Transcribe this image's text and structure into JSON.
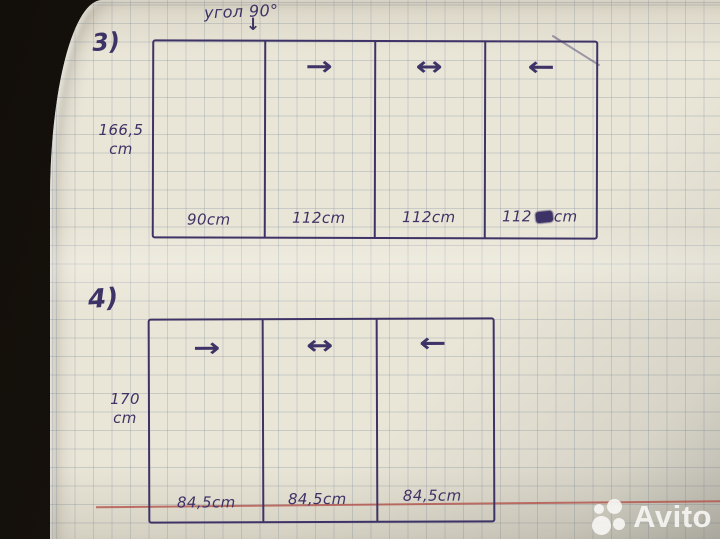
{
  "annotation": {
    "text": "угол 90°",
    "arrow": "↓"
  },
  "sketch3": {
    "label": "3)",
    "height_value": "166,5",
    "height_unit": "cm",
    "sections": [
      {
        "width_label": "90cm",
        "arrow": ""
      },
      {
        "width_label": "112cm",
        "arrow": "→"
      },
      {
        "width_label": "112cm",
        "arrow": "↔"
      },
      {
        "width_label": "112",
        "unit": "cm",
        "scribbled": true,
        "arrow": "←"
      }
    ]
  },
  "sketch4": {
    "label": "4)",
    "height_value": "170",
    "height_unit": "cm",
    "sections": [
      {
        "width_label": "84,5cm",
        "arrow": "→"
      },
      {
        "width_label": "84,5cm",
        "arrow": "↔"
      },
      {
        "width_label": "84,5cm",
        "arrow": "←"
      }
    ]
  },
  "watermark": {
    "brand": "Avito"
  },
  "colors": {
    "ink": "#3e3366",
    "paper": "#e9e5d7",
    "margin_line": "#b2504a",
    "table": "#15110c"
  }
}
